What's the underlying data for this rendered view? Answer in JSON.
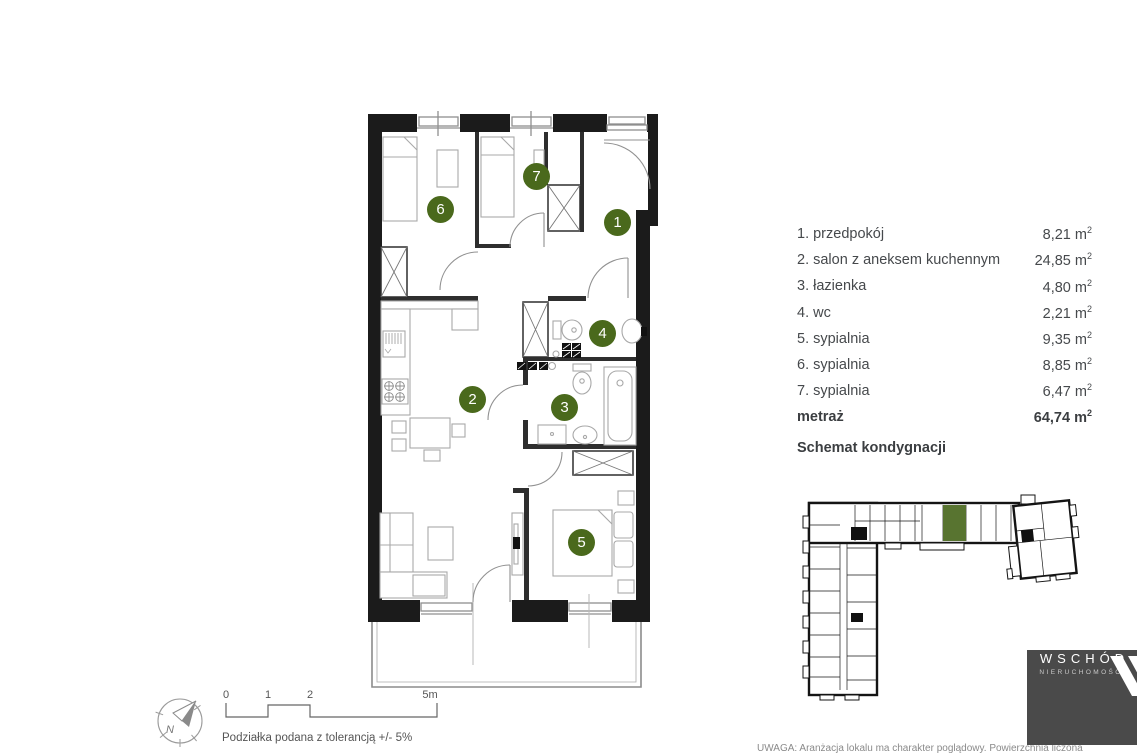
{
  "floor_plan": {
    "rooms": [
      {
        "number": "1",
        "name": "przedpokój",
        "area": "8,21"
      },
      {
        "number": "2",
        "name": "salon z aneksem kuchennym",
        "area": "24,85"
      },
      {
        "number": "3",
        "name": "łazienka",
        "area": "4,80"
      },
      {
        "number": "4",
        "name": "wc",
        "area": "2,21"
      },
      {
        "number": "5",
        "name": "sypialnia",
        "area": "9,35"
      },
      {
        "number": "6",
        "name": "sypialnia",
        "area": "8,85"
      },
      {
        "number": "7",
        "name": "sypialnia",
        "area": "6,47"
      }
    ]
  },
  "legend": {
    "items": [
      {
        "label": "1. przedpokój",
        "area": "8,21"
      },
      {
        "label": "2. salon z aneksem kuchennym",
        "area": "24,85"
      },
      {
        "label": "3. łazienka",
        "area": "4,80"
      },
      {
        "label": "4. wc",
        "area": "2,21"
      },
      {
        "label": "5. sypialnia",
        "area": "9,35"
      },
      {
        "label": "6. sypialnia",
        "area": "8,85"
      },
      {
        "label": "7. sypialnia",
        "area": "6,47"
      }
    ],
    "total_label": "metraż",
    "total_area": "64,74",
    "unit": "m",
    "unit_sup": "2"
  },
  "schematic": {
    "heading": "Schemat kondygnacji",
    "highlight_color": "#587430"
  },
  "scale_bar": {
    "labels": [
      "0",
      "1",
      "2",
      "5m"
    ],
    "caption": "Podziałka podana z tolerancją +/- 5%"
  },
  "compass": {
    "north_label": "N"
  },
  "logo": {
    "brand": "WSCHÓD",
    "subtitle": "NIERUCHOMOŚCI"
  },
  "disclaimer": "UWAGA: Aranżacja lokalu ma charakter poglądowy. Powierzchnia liczona",
  "colors": {
    "room_badge": "#4a691c",
    "unit_highlight": "#587430",
    "logo_bg": "#4a4a4a",
    "text_primary": "#46494c"
  }
}
